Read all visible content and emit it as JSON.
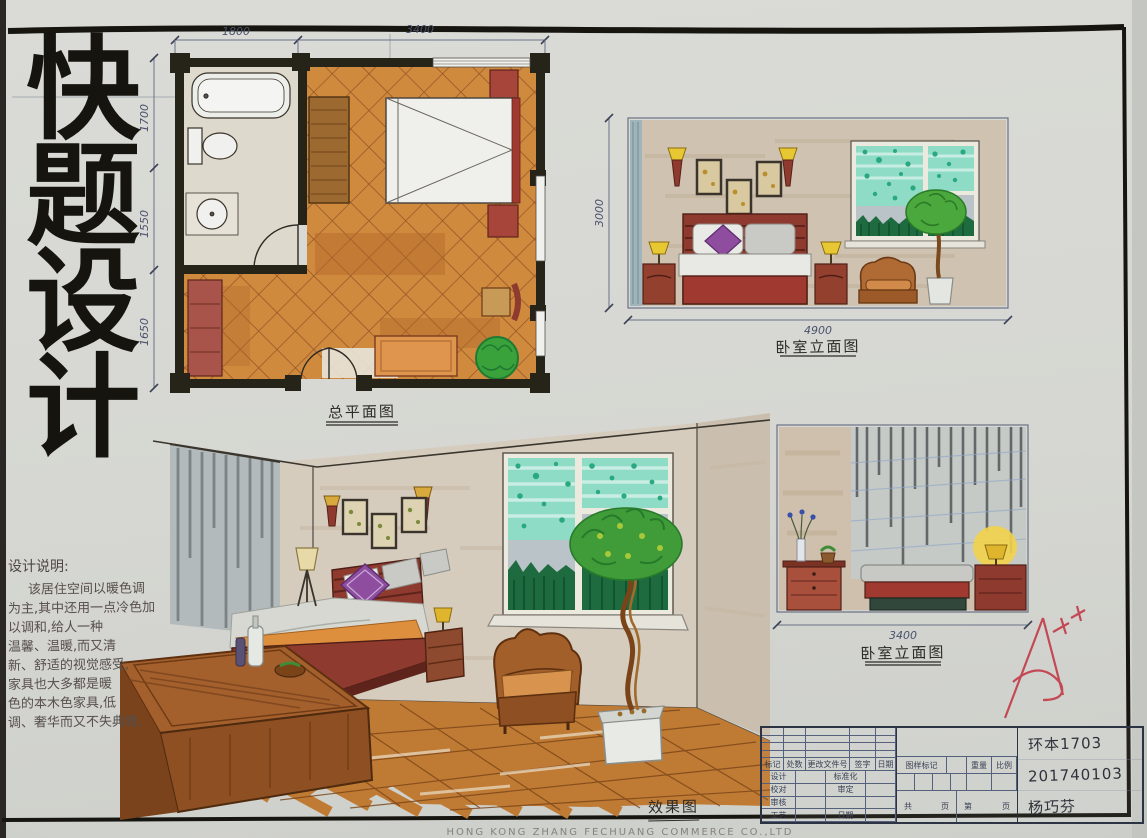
{
  "colors": {
    "paper": "#d6d7d2",
    "ink": "#211e19",
    "pencil": "#5a6173",
    "pen_blue": "#3c4a66",
    "floor_orange": "#cf8a3e",
    "lattice_brown": "#8a4a22",
    "wood": "#9c5f2a",
    "wood_dark": "#7a431c",
    "maroon_furniture": "#a03a30",
    "teal_curtain": "#8fdcc6",
    "teal_dot": "#2aa87e",
    "beige_wall": "#cfc2b0",
    "gray_curtain": "#b9bfbe",
    "lamp_yellow": "#e8c832",
    "purple_pillow": "#8e4d9e",
    "plant_green": "#3f9c38",
    "armchair_brown": "#b06a33",
    "red_pen": "#c23b47"
  },
  "board": {
    "title_vertical": "快题设计",
    "footer_print": "HONG KONG ZHANG FECHUANG COMMERCE CO.,LTD"
  },
  "plan": {
    "label": "总平面图",
    "dim_top_left": "1800",
    "dim_top_right": "3400",
    "dim_left_1": "1700",
    "dim_left_2": "1550",
    "dim_left_3": "1650"
  },
  "elev1": {
    "label": "卧室立面图",
    "dim_bottom": "4900",
    "dim_left": "3000"
  },
  "elev2": {
    "label": "卧室立面图",
    "dim_bottom": "3400",
    "dim_left": "3000"
  },
  "render": {
    "label": "效果图"
  },
  "notes": {
    "title": "设计说明:",
    "line1": "该居住空间以暖色调",
    "line2": "为主,其中还用一点冷色加",
    "line3": "以调和,给人一种",
    "line4": "温馨、温暖,而又清",
    "line5": "新、舒适的视觉感受,",
    "line6": "家具也大多都是暖",
    "line7": "色的本木色家具,低",
    "line8": "调、奢华而又不失典雅,"
  },
  "titleblock": {
    "headers": [
      "标记",
      "处数",
      "更改文件号",
      "签字",
      "日期"
    ],
    "rows": [
      {
        "a": "设计",
        "b": "标准化"
      },
      {
        "a": "校对",
        "b": "审定"
      },
      {
        "a": "审核",
        "b": ""
      },
      {
        "a": "工艺",
        "b": "日期"
      }
    ],
    "middle": {
      "mark": "图样标记",
      "weight": "重量",
      "scale": "比例",
      "total": "共",
      "page": "页",
      "no": "第",
      "page2": "页"
    },
    "written": [
      "环本1703",
      "201740103",
      "杨巧芬"
    ]
  }
}
